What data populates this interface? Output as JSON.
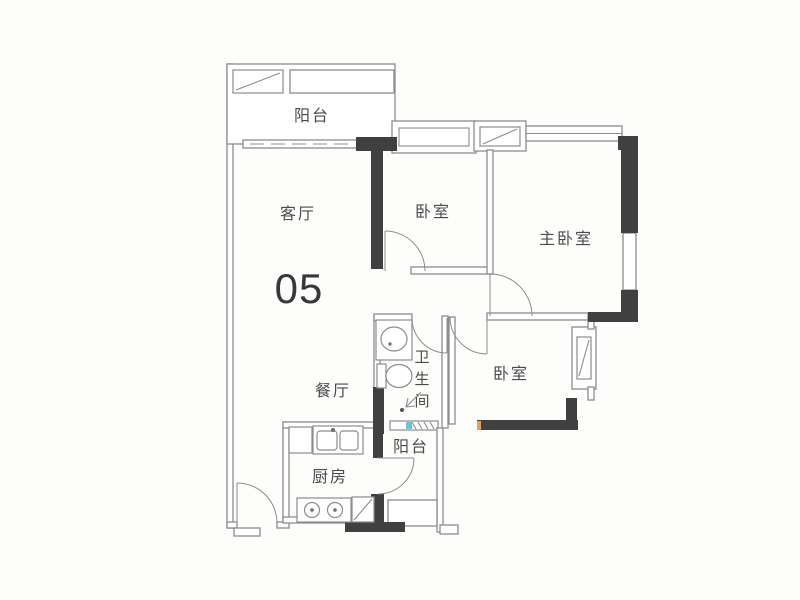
{
  "floorplan": {
    "unit_number": "05",
    "labels": {
      "balcony_top": "阳台",
      "living_room": "客厅",
      "dining_room": "餐厅",
      "kitchen": "厨房",
      "bedroom_top": "卧室",
      "master_bedroom": "主卧室",
      "bedroom_right": "卧室",
      "balcony_bottom": "阳台",
      "bathroom_chars": [
        "卫",
        "生",
        "间"
      ]
    },
    "colors": {
      "background": "#fdfdfc",
      "wall_thick": "#404040",
      "wall_thin": "#8c8c8c",
      "text": "#4a4a4a",
      "tick_cyan": "#66c8d4",
      "tick_orange": "#e0a45a"
    }
  }
}
